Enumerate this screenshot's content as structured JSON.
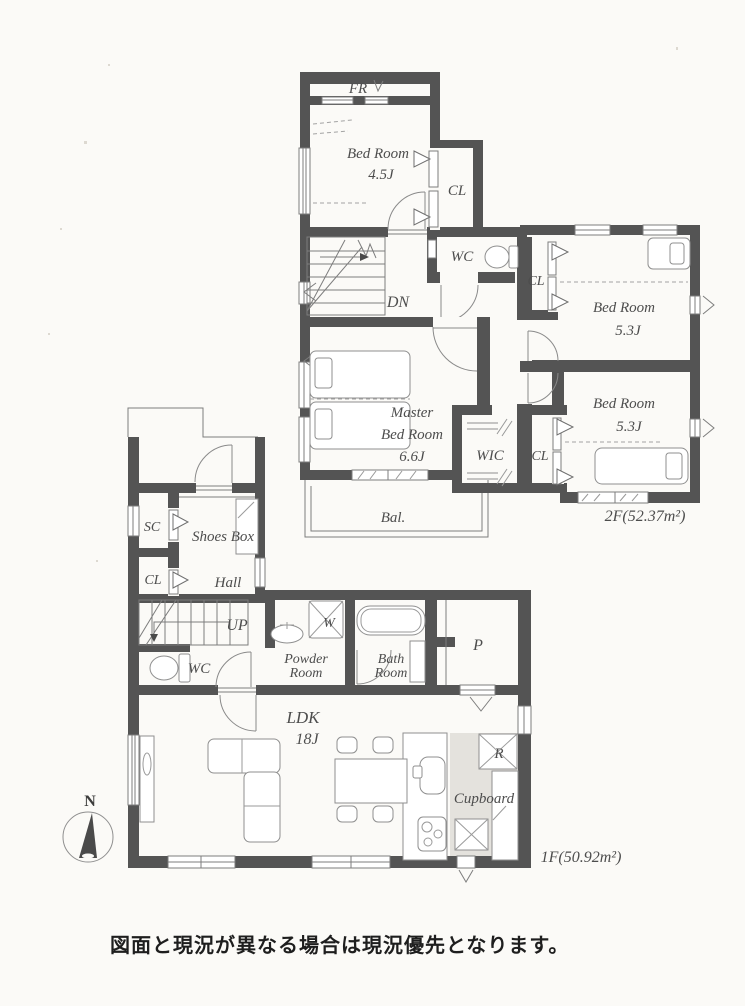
{
  "colors": {
    "wall": "#545454",
    "paper": "#fbfaf7",
    "cupboard_shade": "#e4e2dd",
    "label_ink": "#4d4d4d",
    "footer_ink": "#1e1e1e"
  },
  "floor_2f": {
    "area_label": "2F(52.37m²)",
    "fr": "FR",
    "bedroom_45": {
      "name": "Bed Room",
      "size": "4.5J"
    },
    "closet_a": "CL",
    "wc": "WC",
    "stairs": "DN",
    "closet_b": "CL",
    "bedroom_53_upper": {
      "name": "Bed Room",
      "size": "5.3J"
    },
    "bedroom_53_lower": {
      "name": "Bed Room",
      "size": "5.3J"
    },
    "master": {
      "line1": "Master",
      "line2": "Bed Room",
      "size": "6.6J"
    },
    "wic": "WIC",
    "closet_c": "CL",
    "balcony": "Bal."
  },
  "floor_1f": {
    "area_label": "1F(50.92m²)",
    "shoe_closet": "SC",
    "shoes_box": "Shoes Box",
    "closet": "CL",
    "hall": "Hall",
    "stairs": "UP",
    "wc": "WC",
    "washer": "W",
    "powder": {
      "line1": "Powder",
      "line2": "Room"
    },
    "bath": {
      "line1": "Bath",
      "line2": "Room"
    },
    "pantry": "P",
    "ldk": {
      "name": "LDK",
      "size": "18J"
    },
    "refrigerator": "R",
    "cupboard": "Cupboard"
  },
  "compass": {
    "north": "N"
  },
  "footer": {
    "disclaimer": "図面と現況が異なる場合は現況優先となります。"
  }
}
